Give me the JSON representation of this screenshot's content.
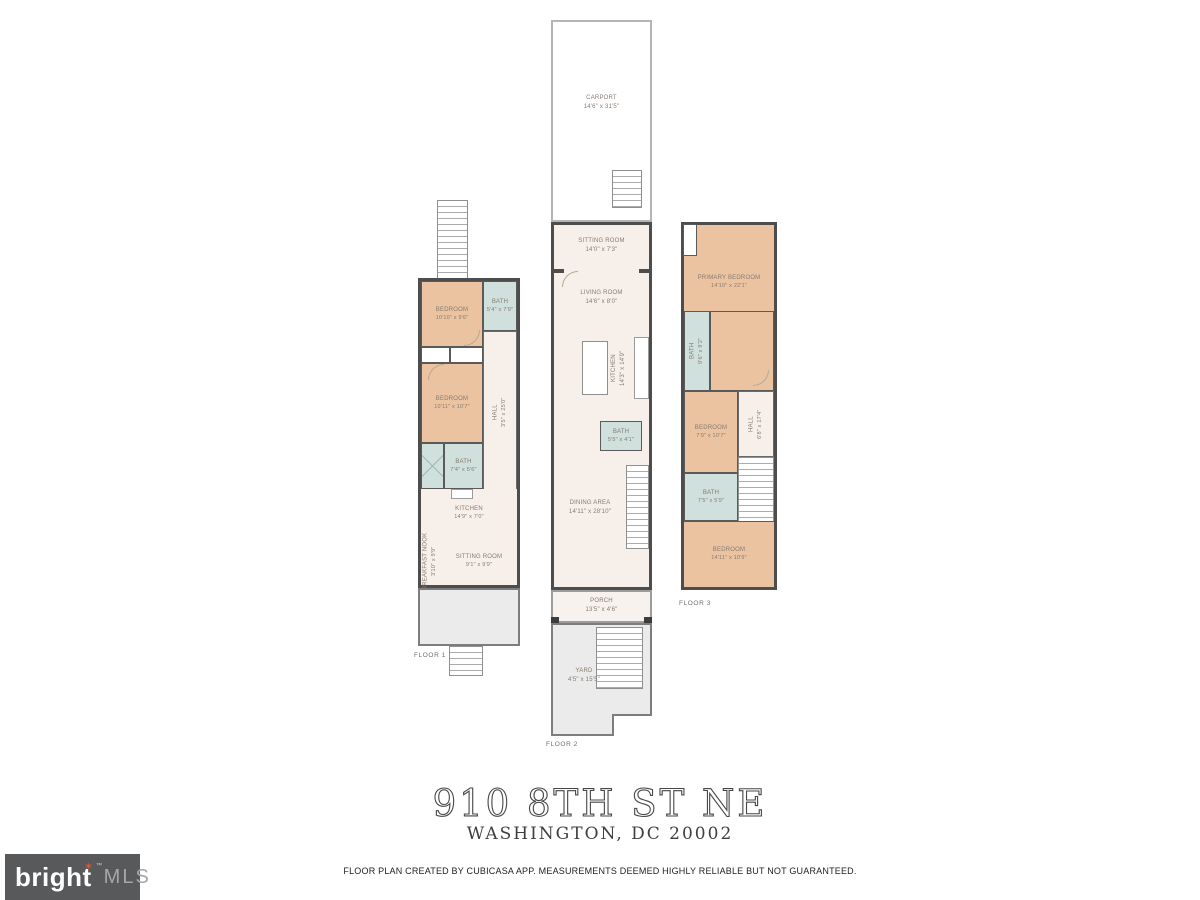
{
  "page": {
    "title": "910 8TH ST NE",
    "subtitle": "WASHINGTON, DC 20002",
    "disclaimer": "FLOOR PLAN CREATED BY CUBICASA APP. MEASUREMENTS DEEMED HIGHLY RELIABLE BUT NOT GUARANTEED."
  },
  "logo": {
    "brand": "bright",
    "suffix": "MLS",
    "tm": "™",
    "star": "✶"
  },
  "colors": {
    "bedroom_fill": "#ecc3a1",
    "bath_fill": "#cfe0dd",
    "interior_fill": "#f7efe9",
    "wall": "#4d4d4d",
    "outdoor_fill": "#ebebeb",
    "logo_background": "#58595b",
    "logo_star": "#e0563e"
  },
  "floors": {
    "floor1": {
      "label": "FLOOR 1",
      "rooms": {
        "bedroom1": {
          "name": "BEDROOM",
          "dims": "10'10\" x 9'6\""
        },
        "bath1": {
          "name": "BATH",
          "dims": "5'4\" x 7'9\""
        },
        "bedroom2": {
          "name": "BEDROOM",
          "dims": "10'11\" x 10'7\""
        },
        "hall": {
          "name": "HALL",
          "dims": "3'5\" x 25'0\""
        },
        "bath2": {
          "name": "BATH",
          "dims": "7'4\" x 5'6\""
        },
        "kitchen": {
          "name": "KITCHEN",
          "dims": "14'9\" x 7'0\""
        },
        "sitting": {
          "name": "SITTING ROOM",
          "dims": "9'1\" x 9'9\""
        },
        "nook": {
          "name": "BREAKFAST NOOK",
          "dims": "3'10\" x 9'9\""
        }
      }
    },
    "floor2": {
      "label": "FLOOR 2",
      "rooms": {
        "carport": {
          "name": "CARPORT",
          "dims": "14'6\" x 31'5\""
        },
        "sitting": {
          "name": "SITTING ROOM",
          "dims": "14'0\" x 7'3\""
        },
        "living": {
          "name": "LIVING ROOM",
          "dims": "14'6\" x 8'0\""
        },
        "kitchen": {
          "name": "KITCHEN",
          "dims": "14'3\" x 14'9\""
        },
        "bath": {
          "name": "BATH",
          "dims": "5'5\" x 4'1\""
        },
        "dining": {
          "name": "DINING AREA",
          "dims": "14'11\" x 28'10\""
        },
        "porch": {
          "name": "PORCH",
          "dims": "13'5\" x 4'6\""
        },
        "yard": {
          "name": "YARD",
          "dims": "4'5\" x 15'5\""
        }
      }
    },
    "floor3": {
      "label": "FLOOR 3",
      "rooms": {
        "primary": {
          "name": "PRIMARY BEDROOM",
          "dims": "14'10\" x 22'1\""
        },
        "bath1": {
          "name": "BATH",
          "dims": "9'6\" x 9'2\""
        },
        "bedroom1": {
          "name": "BEDROOM",
          "dims": "7'9\" x 10'7\""
        },
        "hall": {
          "name": "HALL",
          "dims": "6'8\" x 17'4\""
        },
        "bath2": {
          "name": "BATH",
          "dims": "7'5\" x 5'9\""
        },
        "bedroom2": {
          "name": "BEDROOM",
          "dims": "14'11\" x 10'9\""
        }
      }
    }
  }
}
